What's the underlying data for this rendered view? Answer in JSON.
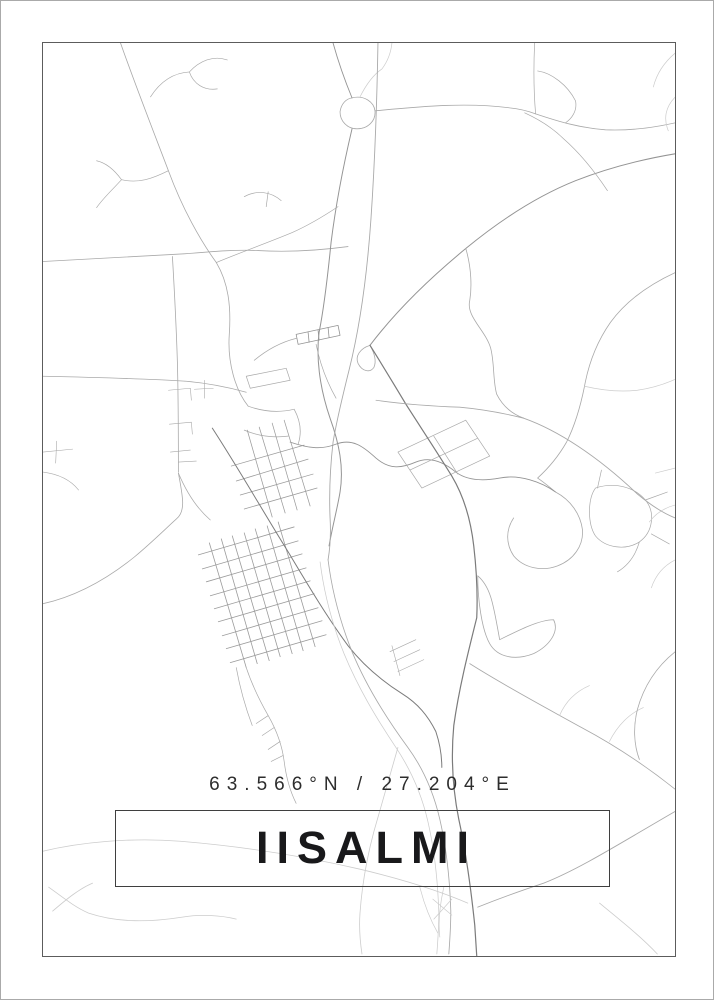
{
  "poster": {
    "location": "Iisalmi",
    "coordinates_label": "63.566°N / 27.204°E",
    "title": "IISALMI",
    "colors": {
      "background": "#ffffff",
      "outer_edge": "#aaaaaa",
      "frame_border": "#5c5c5c",
      "title_box_border": "#3f3f3f",
      "title_text": "#19191b",
      "coordinates_text": "#2d2d2d",
      "road_light": "#a9a9a9",
      "road_medium": "#949494",
      "road_grid": "#9b9b9b",
      "road_dark": "#7b7b7b",
      "road_faint": "#cccccc"
    },
    "map": {
      "name": "iisalmi-street-map",
      "viewbox": "42 42 634 915",
      "paths": [
        {
          "d": "M120,42 C134,82 152,128 168,170 C182,208 200,240 216,262 C228,282 231,306 229,334 C227,362 235,390 248,406",
          "c": "light",
          "w": 0.8
        },
        {
          "d": "M150,96 C159,82 172,72 189,71 M189,71 C199,60 213,54 227,59 M189,71 C193,83 204,90 217,88",
          "c": "light",
          "w": 0.7
        },
        {
          "d": "M168,170 C152,178 138,183 121,179 M121,179 C111,190 103,197 96,207 M121,179 C113,168 105,162 96,160",
          "c": "light",
          "w": 0.7
        },
        {
          "d": "M244,196 C257,189 271,191 281,200 M268,191 L266,206",
          "c": "light",
          "w": 0.7
        },
        {
          "d": "M42,261 C92,258 140,256 188,253 C212,251 234,249 258,250 C290,252 318,250 348,246",
          "c": "light",
          "w": 0.8
        },
        {
          "d": "M172,256 C174,290 176,330 177,362 C178,400 178,440 178,472",
          "c": "light",
          "w": 0.8
        },
        {
          "d": "M168,390 L190,388 M190,388 L191,400 M169,424 L191,422 M191,422 L192,434 M170,452 L190,450 M178,462 L196,461 M194,389 L213,388 M204,380 L204,398",
          "c": "light",
          "w": 0.6
        },
        {
          "d": "M42,376 C90,377 138,378 186,381 C208,383 228,387 246,392",
          "c": "light",
          "w": 0.8
        },
        {
          "d": "M42,604 C78,596 108,578 134,557 C152,542 166,528 176,519 C186,511 182,495 178,473",
          "c": "light",
          "w": 0.8
        },
        {
          "d": "M178,473 C186,492 196,508 210,520",
          "c": "light",
          "w": 0.7
        },
        {
          "d": "M42,452 L72,449 M56,441 L55,463 M42,472 C58,474 70,480 78,490",
          "c": "light",
          "w": 0.6
        },
        {
          "d": "M352,97 C364,94 374,101 375,110 C376,120 368,128 357,128 C347,128 340,120 340,111 C341,103 346,98 352,97",
          "c": "light",
          "w": 0.8
        },
        {
          "d": "M333,42 C338,60 345,80 352,97",
          "c": "medium",
          "w": 0.9
        },
        {
          "d": "M360,96 C366,84 373,74 382,68 C388,60 391,52 392,42",
          "c": "faint",
          "w": 0.7
        },
        {
          "d": "M375,110 C418,106 465,101 510,107 C520,108 528,110 536,113 M536,113 C560,121 580,127 606,129 C630,130 654,127 676,122",
          "c": "light",
          "w": 0.8
        },
        {
          "d": "M536,113 C534,90 534,64 535,42 M538,70 C552,72 568,84 576,100 C578,110 572,118 566,122",
          "c": "light",
          "w": 0.7
        },
        {
          "d": "M352,128 C344,162 336,202 331,242 C327,282 323,312 319,332 C316,356 319,386 330,418 C339,443 344,467 340,492 C337,510 332,528 329,546",
          "c": "medium",
          "w": 1
        },
        {
          "d": "M378,42 C377,100 375,160 371,218 C367,276 360,326 349,370 C343,394 337,418 333,442 C330,468 329,494 330,518 C331,534 330,548 328,560",
          "c": "light",
          "w": 0.9
        },
        {
          "d": "M216,262 C240,252 268,242 292,232 C310,224 326,214 338,206",
          "c": "light",
          "w": 0.7
        },
        {
          "d": "M676,153 C646,158 612,166 576,180 C536,196 500,220 466,248 C432,276 398,308 370,345",
          "c": "medium",
          "w": 1
        },
        {
          "d": "M525,112 C538,118 552,126 564,138 C580,152 596,172 608,190",
          "c": "light",
          "w": 0.7
        },
        {
          "d": "M676,272 C650,284 627,300 611,322 C597,342 589,364 585,386 C581,406 575,426 567,442 C559,456 549,468 538,478 M538,478 C544,482 550,487 556,492",
          "c": "light",
          "w": 0.8
        },
        {
          "d": "M585,386 C602,390 620,392 638,390 C652,388 665,384 676,379",
          "c": "faint",
          "w": 0.7
        },
        {
          "d": "M676,52 C664,62 657,74 654,86 M676,96 C666,106 664,118 669,130",
          "c": "faint",
          "w": 0.7
        },
        {
          "d": "M370,345 C374,352 377,360 374,367 C370,373 362,371 358,363 C355,356 360,348 370,345",
          "c": "light",
          "w": 0.8
        },
        {
          "d": "M290,442 C308,448 321,450 336,444 C352,438 363,446 376,458 C390,470 402,468 416,462 C430,456 444,462 456,472 C468,481 484,481 500,478 C520,474 542,482 556,492",
          "c": "medium",
          "w": 0.9
        },
        {
          "d": "M556,492 C571,500 581,514 583,530 C584,546 574,560 558,566 C542,572 524,568 514,556 C506,544 506,530 514,518",
          "c": "light",
          "w": 0.8
        },
        {
          "d": "M596,488 C614,482 634,486 646,500 C656,512 654,532 640,542 C626,551 606,548 596,536 C588,524 588,499 596,488 M646,500 L668,492 M652,534 L670,544 M640,542 C636,556 628,566 618,572 M602,470 L598,488",
          "c": "light",
          "w": 0.7
        },
        {
          "d": "M676,468 L656,473 M676,505 C664,508 656,514 650,522 M676,560 C664,566 656,576 652,588",
          "c": "faint",
          "w": 0.7
        },
        {
          "d": "M398,452 L466,420 M410,470 L478,438 M422,488 L490,456 M398,452 L422,488 M434,436 L458,474 M466,420 L490,456",
          "c": "light",
          "w": 0.7
        },
        {
          "d": "M296,334 L338,325 M298,344 L340,335 M296,334 L298,344 M338,325 L340,335 M308,332 L309,342 M318,330 L319,340 M328,327 L329,337",
          "c": "medium",
          "w": 0.8
        },
        {
          "d": "M316,344 C320,364 327,382 336,398 M296,338 C280,342 266,350 254,360",
          "c": "light",
          "w": 0.7
        },
        {
          "d": "M248,406 C262,411 278,413 294,409 M294,409 C300,420 302,432 298,444 M244,430 C258,436 272,438 288,436",
          "c": "light",
          "w": 0.75
        },
        {
          "d": "M246,376 L286,368 M250,388 L290,380 M246,376 L250,388 M286,368 L290,380",
          "c": "light",
          "w": 0.7
        },
        {
          "d": "M209,543 L246,668 M221,539 L257,664 M232,536 L269,661 M244,533 L280,657 M255,529 L292,654 M267,526 L303,651 M278,522 L315,647",
          "c": "grid",
          "w": 0.8
        },
        {
          "d": "M198,555 L294,527 M202,569 L298,541 M206,582 L302,554 M210,596 L306,568 M214,609 L310,581 M218,622 L314,594 M222,636 L318,608 M226,649 L322,621 M230,663 L326,635",
          "c": "grid",
          "w": 0.8
        },
        {
          "d": "M247,430 L272,517 M259,427 L285,513 M272,423 L297,510 M284,420 L310,506",
          "c": "grid",
          "w": 0.75
        },
        {
          "d": "M231,466 L304,445 M236,481 L308,459 M240,495 L313,474 M244,509 L317,488",
          "c": "grid",
          "w": 0.75
        },
        {
          "d": "M212,428 C238,468 262,510 288,552 C306,582 326,616 348,646 C362,664 380,680 402,694 C418,704 428,716 436,732 M436,732 C440,744 442,756 442,768",
          "c": "dark",
          "w": 1
        },
        {
          "d": "M246,668 C252,686 260,702 268,716 C276,730 282,746 284,762 C286,778 290,792 296,804 M268,716 L256,724 M274,728 L262,736 M280,742 L268,750 M283,756 L271,762 M236,668 C240,690 246,710 252,726",
          "c": "light",
          "w": 0.7
        },
        {
          "d": "M390,652 L416,640 M394,662 L420,650 M398,672 L424,660 M392,646 L400,676",
          "c": "light",
          "w": 0.6
        },
        {
          "d": "M328,560 C332,592 340,622 352,652 C366,686 386,718 408,748 C424,770 434,794 440,820 C446,846 450,880 451,912 C451,927 450,942 449,955",
          "c": "light",
          "w": 0.85
        },
        {
          "d": "M320,562 C324,594 332,624 344,654 C358,688 376,718 396,748 C412,772 422,796 428,822 C434,848 438,882 439,914 C439,928 438,942 437,955",
          "c": "faint",
          "w": 0.75
        },
        {
          "d": "M370,345 C382,364 394,384 406,404 C420,426 436,450 452,476 C464,496 471,520 474,546 C477,572 478,596 477,618 C468,654 459,690 454,726 C451,758 453,790 459,820 C466,852 471,888 475,926 L477,957",
          "c": "dark",
          "w": 1.2
        },
        {
          "d": "M466,248 C472,268 472,288 470,300 C466,316 486,330 491,348 C495,364 493,380 497,394 C503,406 513,414 524,418",
          "c": "light",
          "w": 0.8
        },
        {
          "d": "M376,400 C404,404 432,406 460,407 C482,409 504,413 524,418",
          "c": "light",
          "w": 0.8
        },
        {
          "d": "M524,418 C558,430 598,456 638,494 C650,504 663,513 676,518",
          "c": "light",
          "w": 0.9
        },
        {
          "d": "M478,576 C492,588 494,608 500,640 C520,630 540,620 554,620 C560,632 550,646 534,654 C516,661 498,658 490,644 C482,630 478,600 478,576",
          "c": "light",
          "w": 0.8
        },
        {
          "d": "M470,664 C508,688 546,708 582,728 C612,744 646,766 676,790",
          "c": "light",
          "w": 0.85
        },
        {
          "d": "M560,716 C566,702 576,692 590,686 M610,742 C618,726 630,714 644,708",
          "c": "faint",
          "w": 0.7
        },
        {
          "d": "M676,652 C656,668 644,688 638,710 C634,726 634,744 640,760",
          "c": "light",
          "w": 0.8
        },
        {
          "d": "M478,908 C498,900 520,892 544,884 C580,870 624,842 676,812",
          "c": "light",
          "w": 0.9
        },
        {
          "d": "M600,904 C622,922 642,938 658,955",
          "c": "faint",
          "w": 0.8
        },
        {
          "d": "M42,852 C80,843 130,838 180,842 C240,847 300,856 360,870 C402,880 440,892 468,904",
          "c": "faint",
          "w": 0.8
        },
        {
          "d": "M48,888 C62,898 74,908 88,914 C118,924 150,923 182,918 C200,915 220,916 236,920 M52,912 C66,900 78,890 92,884",
          "c": "faint",
          "w": 0.8
        },
        {
          "d": "M398,748 C390,776 382,804 374,832 C367,858 362,886 360,914 C359,928 360,942 362,955",
          "c": "faint",
          "w": 0.8
        },
        {
          "d": "M420,888 C424,904 430,920 438,934 M444,888 C440,906 438,922 440,938 M433,900 L452,916 M452,900 L434,920",
          "c": "faint",
          "w": 0.7
        }
      ]
    }
  }
}
